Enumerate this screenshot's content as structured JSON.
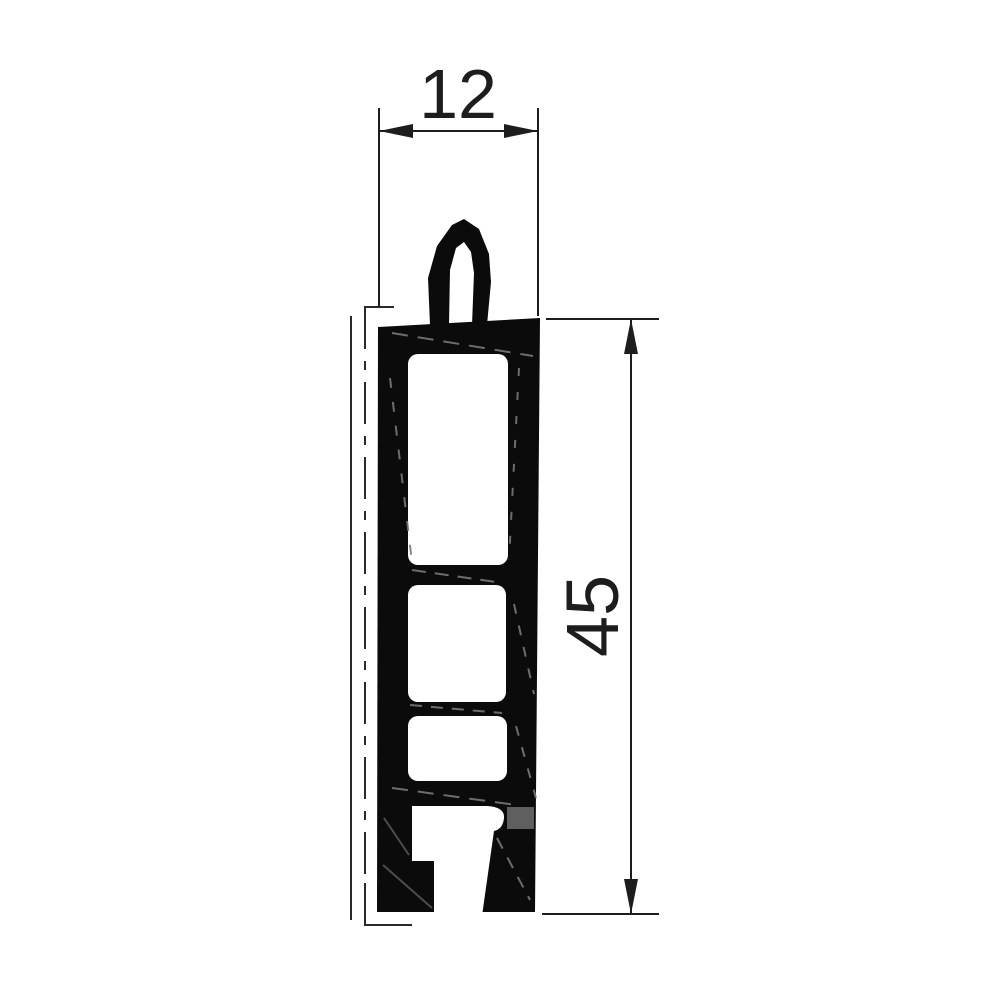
{
  "drawing": {
    "type": "technical-profile-cross-section",
    "dimensions": {
      "width": {
        "label": "12"
      },
      "height": {
        "label": "45"
      }
    },
    "colors": {
      "line": "#1d1d1d",
      "profile_fill": "#0b0b0b",
      "insert_gray": "#5f5f5f",
      "background": "#ffffff"
    }
  }
}
